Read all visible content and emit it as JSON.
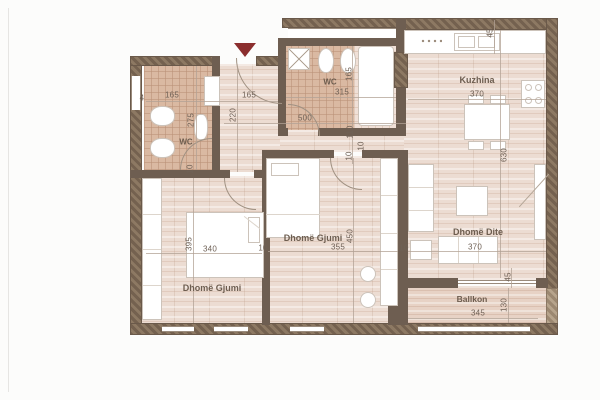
{
  "plan_type": "apartment-floor-plan",
  "rooms": {
    "wc1": {
      "label": "WC",
      "width": "165",
      "height": "275"
    },
    "entry": {
      "width": "165",
      "depth": "220"
    },
    "wc2": {
      "label": "WC",
      "width": "315",
      "height": "165"
    },
    "hall": {
      "length": "500",
      "width": "110"
    },
    "kitchen": {
      "label": "Kuzhina",
      "width": "370",
      "top_offset": "45"
    },
    "living": {
      "label": "Dhomë Dite",
      "width": "370",
      "height": "630"
    },
    "bedroom_mid": {
      "label": "Dhomë Gjumi",
      "width": "355",
      "height": "450"
    },
    "bedroom_left": {
      "label": "Dhomë Gjumi",
      "width": "340",
      "height": "395"
    },
    "balcony": {
      "label": "Ballkon",
      "width": "345",
      "depth": "130",
      "side_offset": "45"
    }
  },
  "wall_labels": {
    "a": "10",
    "b": "10",
    "c": "10",
    "d": "10",
    "e": "10"
  },
  "partial_dim": "4",
  "colors": {
    "wall": "#6e5e51",
    "wall_hatch": "#8d7963",
    "floor_wood": "#ecdcd2",
    "floor_tile": "#dab9a2",
    "furniture": "#ffffff",
    "dimension_text": "#6f6156",
    "entry_arrow": "#8b2e2e",
    "background": "#fcfcfb"
  }
}
